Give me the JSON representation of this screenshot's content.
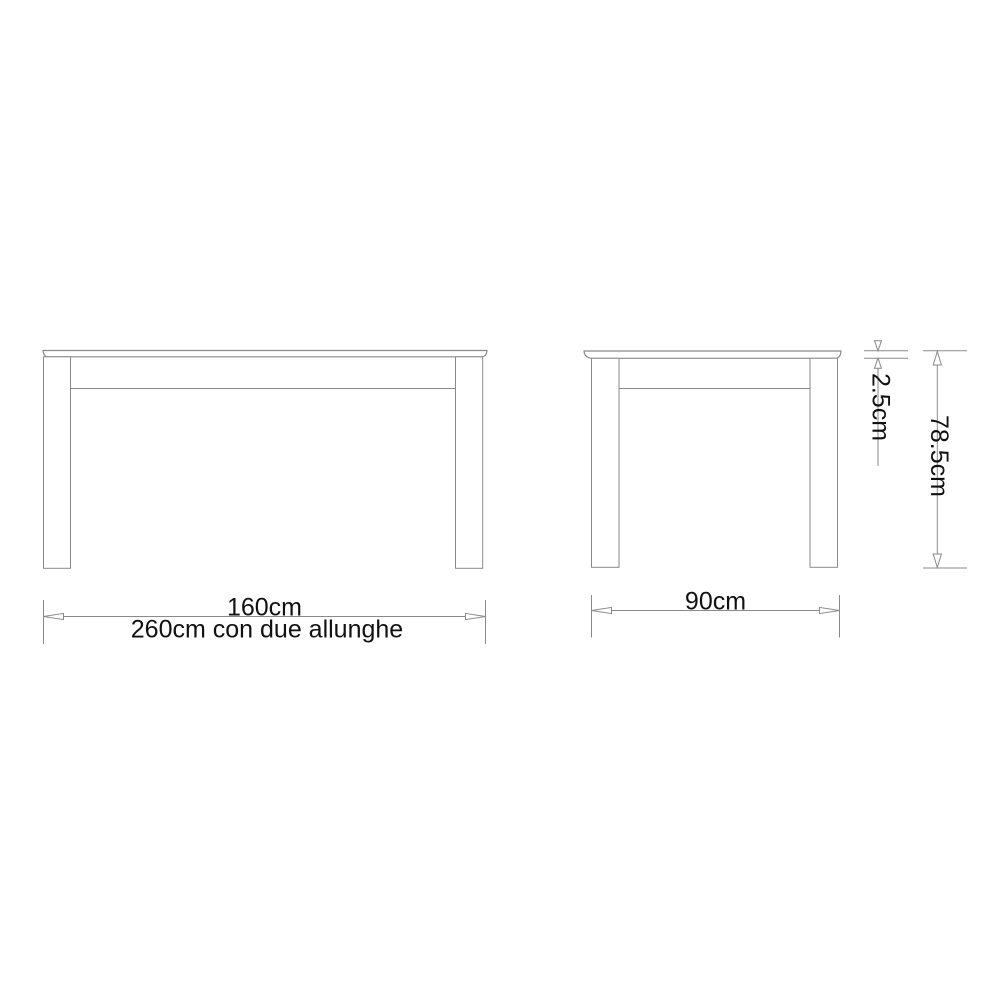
{
  "page": {
    "background_color": "#ffffff"
  },
  "drawing": {
    "line_color": "#8a8a8a",
    "text_color": "#111111"
  },
  "dimensions": {
    "front_width": {
      "label": "160cm"
    },
    "extended_width": {
      "label": "260cm con due allunghe"
    },
    "depth": {
      "label": "90cm"
    },
    "top_thickness": {
      "label": "2.5cm"
    },
    "height": {
      "label": "78.5cm"
    }
  }
}
